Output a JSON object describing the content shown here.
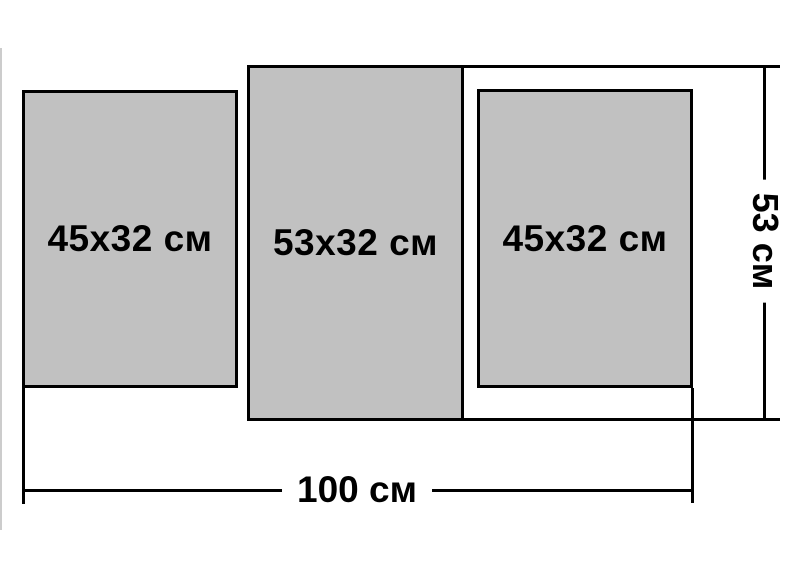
{
  "diagram": {
    "type": "product-size-diagram",
    "description_visible_text_only": true,
    "panels": [
      {
        "position": "left",
        "label": "45x32 см"
      },
      {
        "position": "center",
        "label": "53x32 см"
      },
      {
        "position": "right",
        "label": "45x32 см"
      }
    ],
    "dimensions": {
      "total_width": {
        "label": "100 см"
      },
      "total_height": {
        "label": "53 см"
      }
    },
    "colors": {
      "panel_fill": "#c1c1c1",
      "outline": "#000000",
      "background": "#ffffff"
    }
  }
}
